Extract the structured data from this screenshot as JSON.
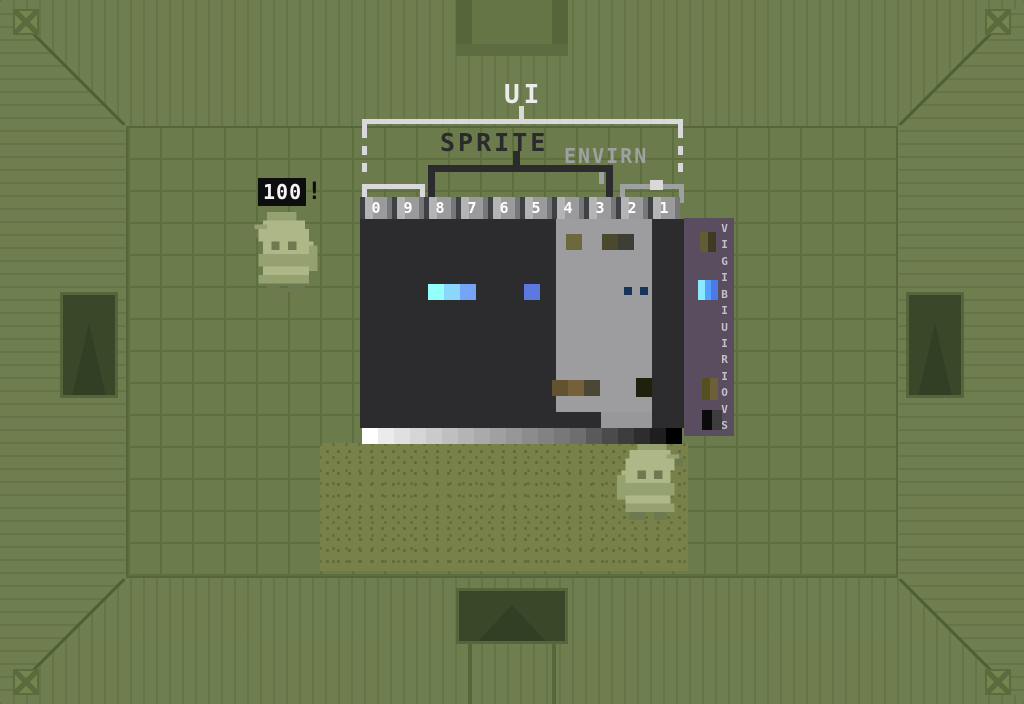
{
  "hud": {
    "ui_label": "UI",
    "sprite_label": "SPRITE",
    "environ_label": "ENVIRN",
    "palette_indices": [
      "0",
      "9",
      "8",
      "7",
      "6",
      "5",
      "4",
      "3",
      "2",
      "1"
    ],
    "score_popup": {
      "value": "100",
      "suffix": "!"
    }
  },
  "palette_editor": {
    "sprite_swatches": [
      "#93fffb",
      "#8bd7fb",
      "#74a3f8"
    ],
    "sprite_swatch_single": "#5c79df",
    "sprite_dots": [
      "#16355b",
      "#16355b"
    ],
    "environ_top_swatches": [
      "#6c693c",
      "#4a482f",
      "#3c3d35"
    ],
    "environ_bottom_swatches": [
      "#63522f",
      "#75603a",
      "#4b4734"
    ],
    "environ_bottom_dark": "#20210c",
    "grayscale_ramp": [
      "#ffffff",
      "#ebebeb",
      "#e0e0e0",
      "#d5d5d5",
      "#cacaca",
      "#bfbfbf",
      "#b4b4b4",
      "#aaaaaa",
      "#a0a0a0",
      "#969696",
      "#8c8c8c",
      "#828282",
      "#787878",
      "#6e6e6e",
      "#5a5a5a",
      "#4b4b4b",
      "#3c3c3c",
      "#2d2d2d",
      "#1e1e1e",
      "#000000"
    ],
    "side_panel": {
      "vertical_label_chars": [
        "V",
        "I",
        "G",
        "I",
        "B",
        "I",
        "U",
        "I",
        "R",
        "I",
        "O",
        "V",
        "S"
      ],
      "olive_top": [
        "#625b33",
        "#3e3b22"
      ],
      "blue_gradient": [
        "#8be9ff",
        "#55a0ff",
        "#4b79e6"
      ],
      "olive_bottom": [
        "#55501f",
        "#6f5f38"
      ],
      "black_gradient": [
        "#0a0a0a",
        "#3c3c3c"
      ]
    }
  },
  "colors": {
    "wall_green": "#6c7c4c",
    "floor_green": "#6b7b4b",
    "sand": "#78814a",
    "door_dark": "#3a4829",
    "panel_dark": "#2c2c2f",
    "panel_light": "#9d9d9f",
    "panel_purple": "#5a4d60",
    "hud_white": "#d9d9db",
    "hud_gray": "#9fa0a2",
    "hud_dark": "#2b2b2e",
    "score_bg": "#0d0d0d"
  }
}
